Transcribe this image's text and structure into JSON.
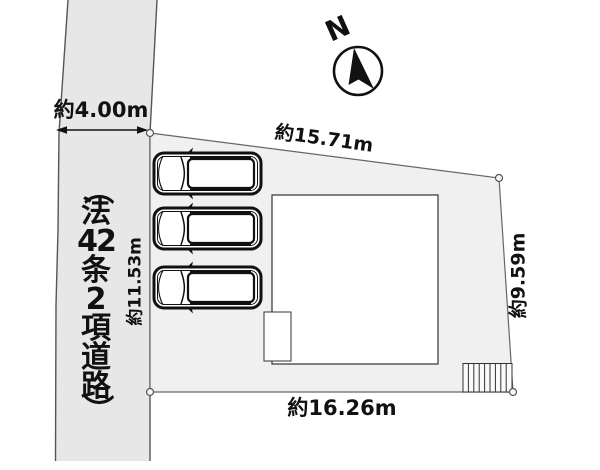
{
  "compass": {
    "north_label": "N"
  },
  "road": {
    "label_full": "（法42条2項道路）",
    "label_chars": [
      "（",
      "法",
      "42",
      "条",
      "2",
      "項",
      "道",
      "路",
      "）"
    ],
    "width_label": "約4.00m"
  },
  "lot": {
    "dim_top": "約15.71m",
    "dim_right": "約9.59m",
    "dim_left": "約11.53m",
    "dim_bottom": "約16.26m"
  },
  "colors": {
    "road_fill": "#e7e7e7",
    "lot_fill": "#f0f0f0",
    "building_fill": "#ffffff",
    "line": "#555555",
    "ink": "#111111"
  }
}
